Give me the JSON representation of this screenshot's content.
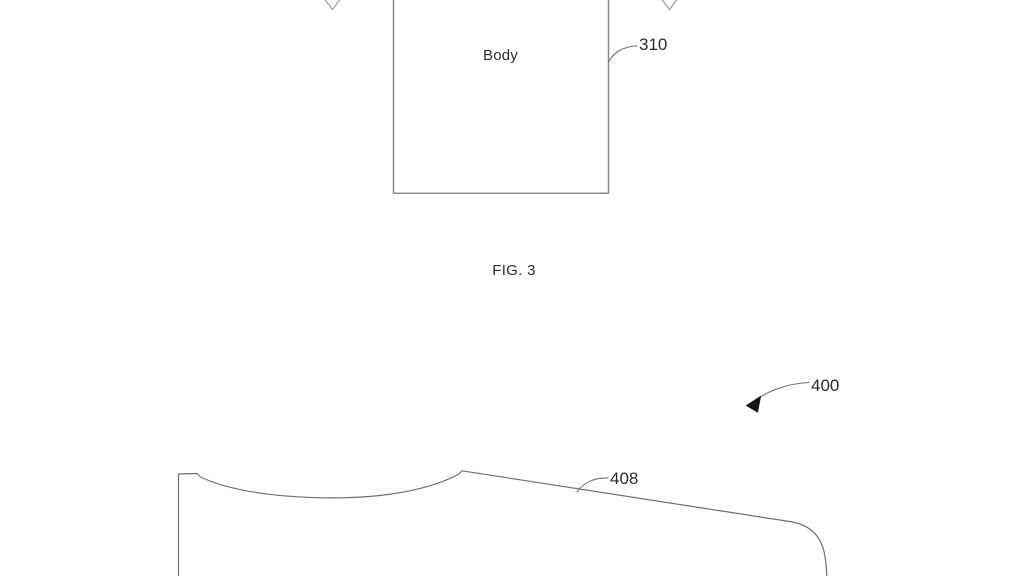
{
  "colors": {
    "background": "#ffffff",
    "line": "#6f6f6f",
    "box_border": "#8c8c8c",
    "text": "#2b2b2b",
    "arrow_light": "#a3a3a3",
    "arrowhead_fill": "#141414"
  },
  "figure3": {
    "body_label": "Body",
    "ref_310": "310",
    "caption": "FIG. 3"
  },
  "figure4": {
    "ref_400": "400",
    "ref_408": "408"
  }
}
